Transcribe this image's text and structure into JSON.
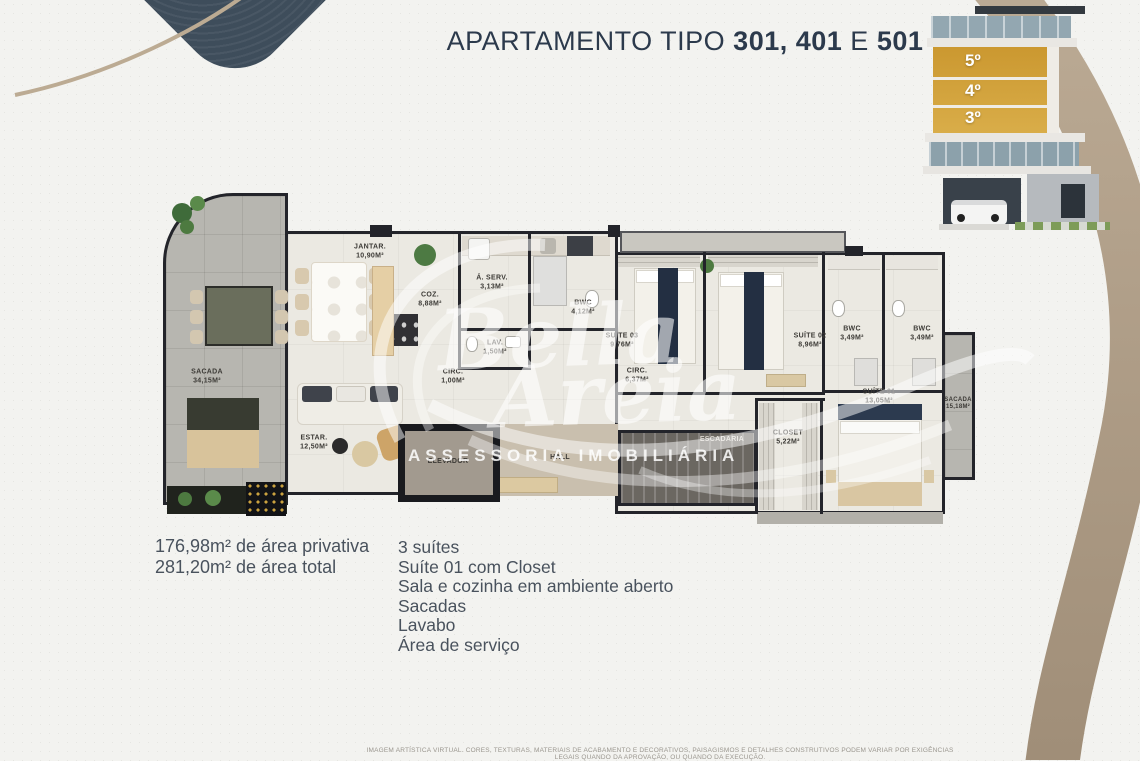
{
  "title": {
    "text_regular_1": "APARTAMENTO TIPO",
    "text_bold_1": "301, 401",
    "text_regular_2": "E",
    "text_bold_2": "501"
  },
  "building_inset": {
    "floor_labels": [
      "5º",
      "4º",
      "3º"
    ]
  },
  "floor_plan": {
    "rooms": [
      {
        "name": "SACADA",
        "area": "34,15m²"
      },
      {
        "name": "JANTAR.",
        "area": "10,90m²"
      },
      {
        "name": "COZ.",
        "area": "8,88m²"
      },
      {
        "name": "Á. SERV.",
        "area": "3,13m²"
      },
      {
        "name": "BWC",
        "area": "4,12m²"
      },
      {
        "name": "LAV.",
        "area": "1,50m²"
      },
      {
        "name": "CIRC.",
        "area": "1,00m²"
      },
      {
        "name": "ESTAR.",
        "area": "12,50m²"
      },
      {
        "name": "SUÍTE 03",
        "area": "9,76m²"
      },
      {
        "name": "CIRC.",
        "area": "6,37m²"
      },
      {
        "name": "SUÍTE 02",
        "area": "8,96m²"
      },
      {
        "name": "BWC",
        "area": "3,49m²"
      },
      {
        "name": "BWC",
        "area": "3,49m²"
      },
      {
        "name": "CLOSET",
        "area": "5,22m²"
      },
      {
        "name": "SUÍTE 01",
        "area": "13,05m²"
      },
      {
        "name": "SACADA",
        "area": "15,18m²"
      },
      {
        "name": "ELEVADOR",
        "area": ""
      },
      {
        "name": "HALL",
        "area": ""
      },
      {
        "name": "ESCADARIA",
        "area": ""
      }
    ]
  },
  "specs": {
    "private_area": "176,98m² de área privativa",
    "total_area": "281,20m² de área total"
  },
  "features": {
    "items": [
      "3 suítes",
      "Suíte 01 com Closet",
      "Sala e cozinha em ambiente aberto",
      "Sacadas",
      "Lavabo",
      "Área de serviço"
    ]
  },
  "watermark": {
    "name_line1": "Bella",
    "name_line2": "Areia",
    "tagline": "ASSESSORIA IMOBILIÁRIA"
  },
  "disclaimer": "IMAGEM ARTÍSTICA VIRTUAL. CORES, TEXTURAS, MATERIAIS DE ACABAMENTO E DECORATIVOS, PAISAGISMOS E DETALHES CONSTRUTIVOS PODEM VARIAR POR EXIGÊNCIAS LEGAIS QUANDO DA APROVAÇÃO, OU QUANDO DA EXECUÇÃO.",
  "colors": {
    "navy": "#2c3a4c",
    "gold": "#cf9d35",
    "beige_ribbon": "#a9947e",
    "background": "#f3f3f0",
    "wall": "#23242a"
  }
}
